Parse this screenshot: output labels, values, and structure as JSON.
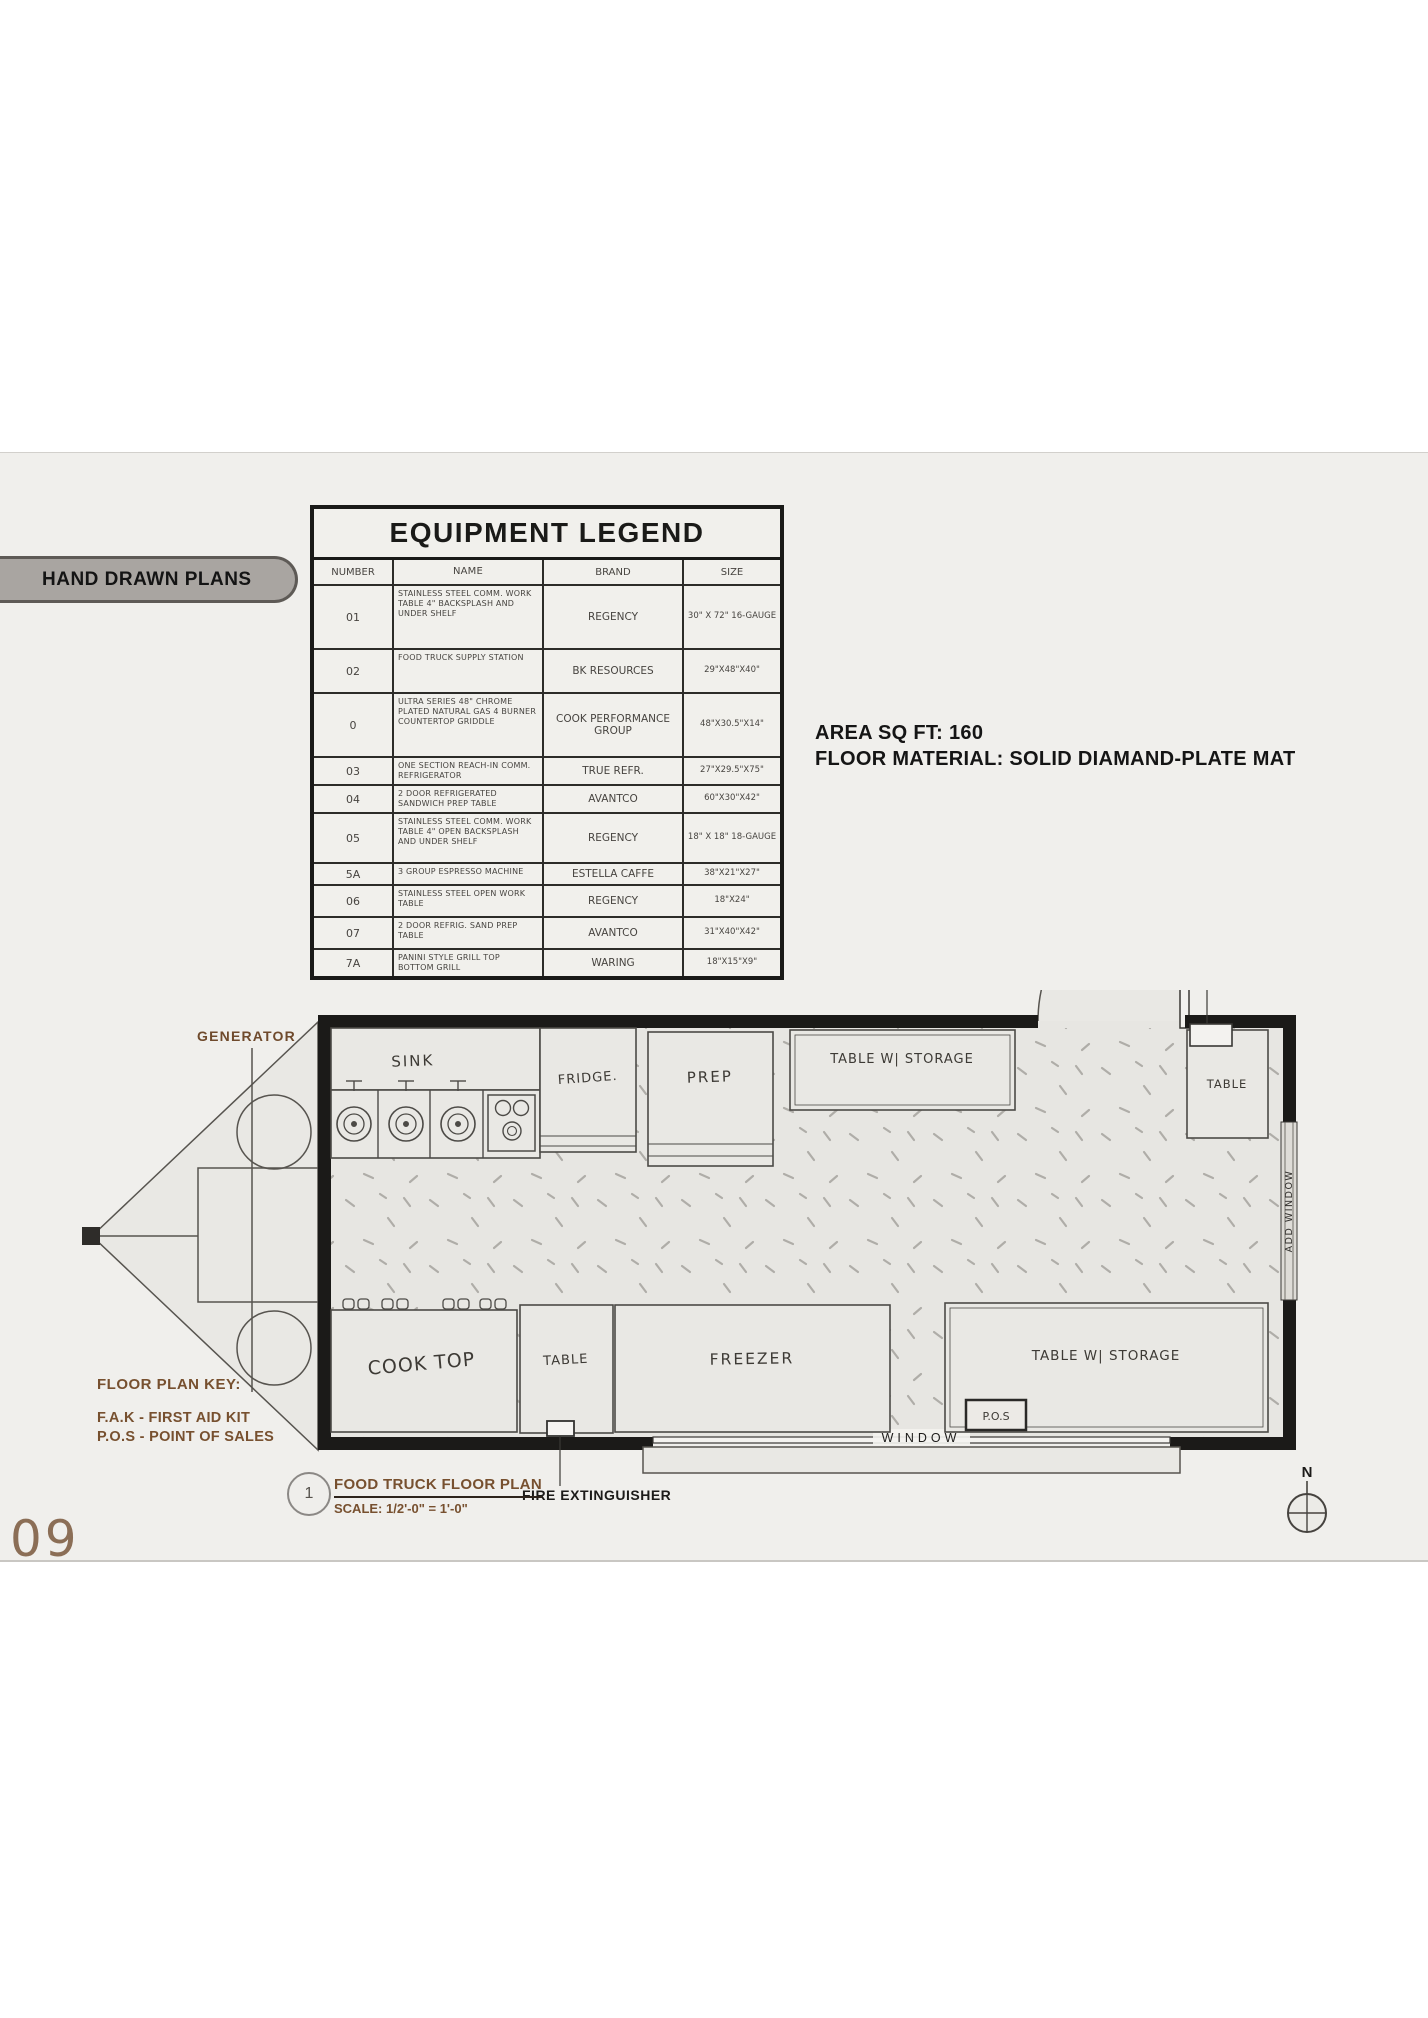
{
  "page": {
    "number": "09"
  },
  "panel": {
    "badge": "HAND DRAWN PLANS"
  },
  "legend": {
    "title": "EQUIPMENT LEGEND",
    "headers": [
      "NUMBER",
      "NAME",
      "BRAND",
      "SIZE"
    ],
    "rows": [
      {
        "number": "01",
        "name": "STAINLESS STEEL COMM. WORK TABLE 4\" BACKSPLASH AND UNDER SHELF",
        "brand": "REGENCY",
        "size": "30\" X 72\" 16-GAUGE"
      },
      {
        "number": "02",
        "name": "FOOD TRUCK SUPPLY STATION",
        "brand": "BK RESOURCES",
        "size": "29\"X48\"X40\""
      },
      {
        "number": "0",
        "name": "ULTRA SERIES 48\" CHROME PLATED NATURAL GAS 4 BURNER COUNTERTOP GRIDDLE",
        "brand": "COOK PERFORMANCE GROUP",
        "size": "48\"X30.5\"X14\""
      },
      {
        "number": "03",
        "name": "ONE SECTION REACH-IN COMM. REFRIGERATOR",
        "brand": "TRUE REFR.",
        "size": "27\"X29.5\"X75\""
      },
      {
        "number": "04",
        "name": "2 DOOR REFRIGERATED SANDWICH PREP TABLE",
        "brand": "AVANTCO",
        "size": "60\"X30\"X42\""
      },
      {
        "number": "05",
        "name": "STAINLESS STEEL COMM. WORK TABLE 4\" OPEN BACKSPLASH AND UNDER SHELF",
        "brand": "REGENCY",
        "size": "18\" X 18\" 18-GAUGE"
      },
      {
        "number": "5A",
        "name": "3 GROUP ESPRESSO MACHINE",
        "brand": "ESTELLA CAFFE",
        "size": "38\"X21\"X27\""
      },
      {
        "number": "06",
        "name": "STAINLESS STEEL OPEN WORK TABLE",
        "brand": "REGENCY",
        "size": "18\"X24\""
      },
      {
        "number": "07",
        "name": "2 DOOR REFRIG. SAND PREP TABLE",
        "brand": "AVANTCO",
        "size": "31\"X40\"X42\""
      },
      {
        "number": "7A",
        "name": "PANINI STYLE GRILL TOP BOTTOM GRILL",
        "brand": "WARING",
        "size": "18\"X15\"X9\""
      }
    ]
  },
  "info": {
    "area": "AREA SQ FT: 160",
    "floor_material": "FLOOR MATERIAL: SOLID DIAMAND-PLATE MAT"
  },
  "plan": {
    "labels": {
      "generator": "GENERATOR",
      "sink": "SINK",
      "fridge": "FRIDGE.",
      "prep": "PREP",
      "table_storage_top": "TABLE W| STORAGE",
      "fak": "F.A.K.",
      "table_top_right": "TABLE",
      "add_window": "ADD WINDOW",
      "cook_top": "COOK TOP",
      "table_bottom": "TABLE",
      "freezer": "FREEZER",
      "table_storage_bottom": "TABLE W| STORAGE",
      "pos": "P.O.S",
      "window": "WINDOW",
      "fire_extinguisher": "FIRE EXTINGUISHER",
      "compass_n": "N"
    },
    "key": {
      "title": "FLOOR PLAN KEY:",
      "items": [
        "F.A.K - FIRST AID KIT",
        "P.O.S - POINT OF SALES"
      ]
    },
    "title_block": {
      "number": "1",
      "title": "FOOD TRUCK FLOOR PLAN",
      "scale": "SCALE: 1/2'-0\" = 1'-0\""
    }
  },
  "colors": {
    "accent_brown": "#77502f",
    "page_number_brown": "#8b6e56",
    "badge_bg": "#a9a5a1",
    "panel_bg": "#f0efec",
    "wall_black": "#1b1a18"
  }
}
